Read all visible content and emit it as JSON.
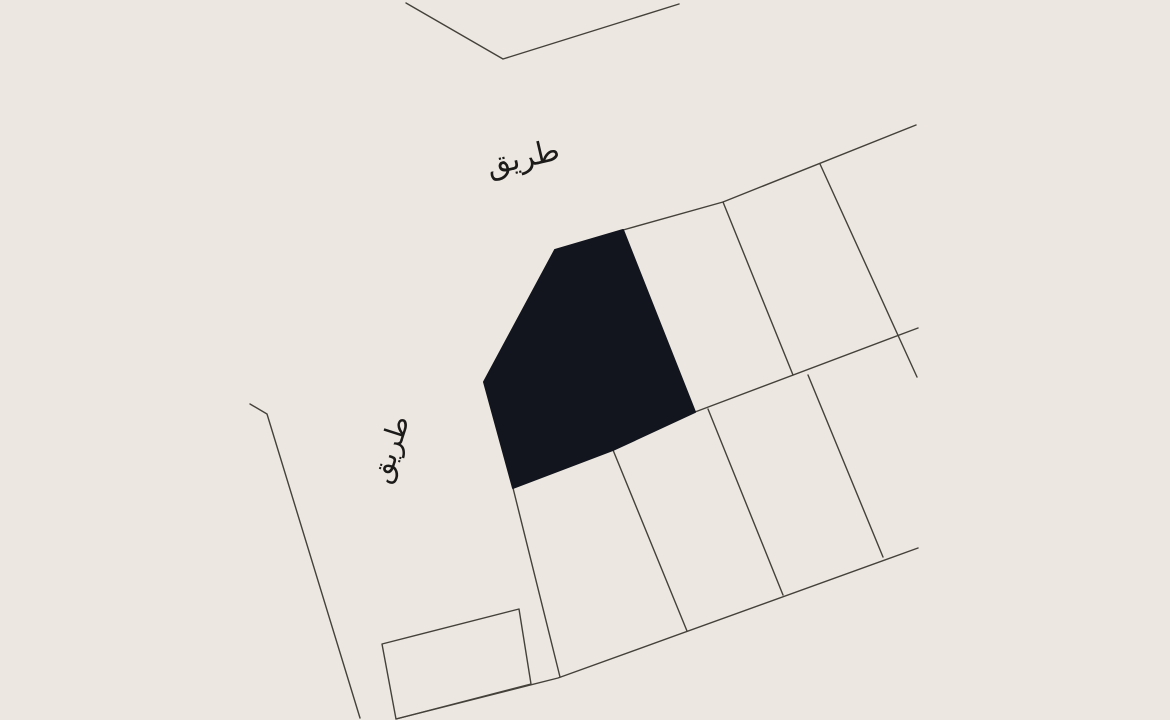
{
  "canvas": {
    "width": 1170,
    "height": 720,
    "background_color": "#ECE8E1",
    "line_color": "#44403A",
    "parcel_fill_color": "#12141E",
    "text_color": "#1C1B19"
  },
  "map": {
    "boundaries": {
      "top_v": [
        [
          406,
          3
        ],
        [
          503,
          59
        ],
        [
          679,
          4
        ]
      ],
      "upper_road_edge": [
        [
          555,
          250
        ],
        [
          623,
          230
        ],
        [
          723,
          202
        ],
        [
          916,
          125
        ]
      ],
      "left_road_edge": [
        [
          250,
          404
        ],
        [
          267,
          414
        ],
        [
          360,
          718
        ]
      ],
      "lower_road_edge": [
        [
          396,
          719
        ],
        [
          558,
          678
        ],
        [
          918,
          548
        ]
      ],
      "middle_block_boundary": [
        [
          695,
          412
        ],
        [
          918,
          328
        ]
      ]
    },
    "parcel_division_lines": [
      [
        [
          723,
          202
        ],
        [
          793,
          375
        ]
      ],
      [
        [
          820,
          164
        ],
        [
          917,
          377
        ]
      ],
      [
        [
          708,
          409
        ],
        [
          783,
          595
        ]
      ],
      [
        [
          808,
          375
        ],
        [
          883,
          557
        ]
      ],
      [
        [
          513,
          488
        ],
        [
          560,
          677
        ]
      ],
      [
        [
          613,
          450
        ],
        [
          687,
          631
        ]
      ]
    ],
    "small_parcel_points": [
      [
        382,
        644
      ],
      [
        519,
        609
      ],
      [
        531,
        684
      ],
      [
        396,
        719
      ]
    ],
    "highlight_parcel": {
      "points": [
        [
          623,
          230
        ],
        [
          555,
          250
        ],
        [
          484,
          382
        ],
        [
          513,
          488
        ],
        [
          613,
          450
        ],
        [
          695,
          412
        ]
      ]
    },
    "labels": [
      {
        "text": "طريق",
        "x": 523,
        "y": 158,
        "rotation_deg": -13,
        "font_size": 30
      },
      {
        "text": "طريق",
        "x": 390,
        "y": 449,
        "rotation_deg": -72,
        "font_size": 28
      }
    ]
  }
}
